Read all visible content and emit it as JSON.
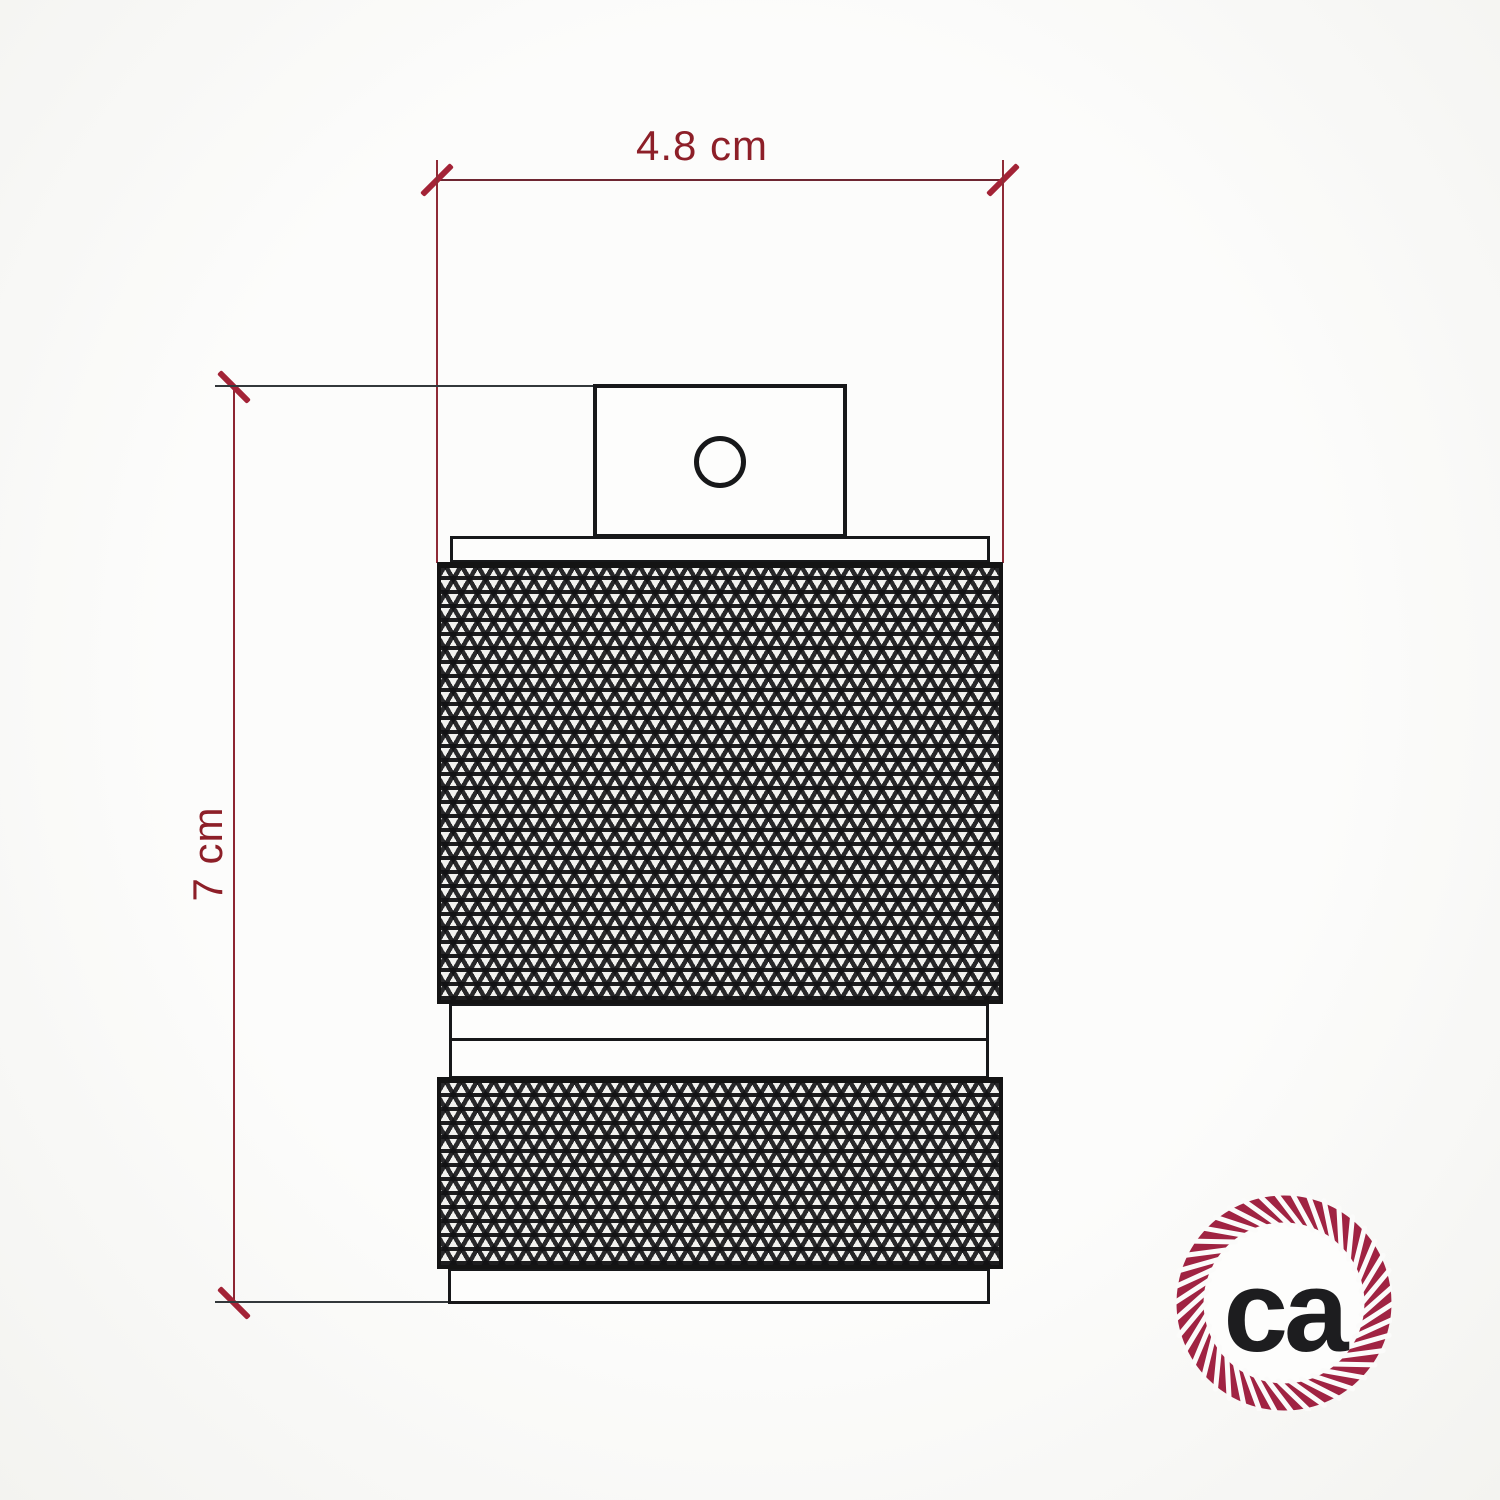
{
  "diagram": {
    "type": "technical-drawing",
    "width_label": "4.8 cm",
    "height_label": "7 cm"
  },
  "logo": {
    "monogram": "ca",
    "icon": "rope-circle-icon"
  },
  "colors": {
    "dimension_label": "#8d1f28",
    "dimension_tick": "#a32336",
    "dimension_line": "#6e2631",
    "extension_line_red": "#8f2b36",
    "extension_line_dark": "#33383b",
    "drawing_outline": "#17181a",
    "logo_ring": "#a02342",
    "logo_text": "#1d1d1f",
    "background": "#f8f8f6"
  }
}
